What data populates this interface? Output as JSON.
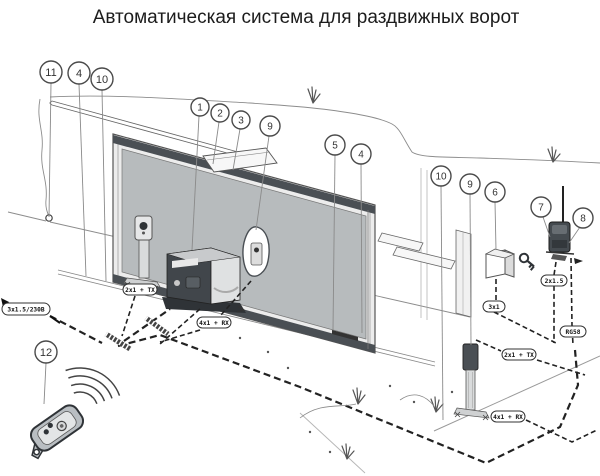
{
  "title": "Автоматическая система для раздвижных ворот",
  "callouts": [
    {
      "n": "11"
    },
    {
      "n": "4"
    },
    {
      "n": "10"
    },
    {
      "n": "1"
    },
    {
      "n": "2"
    },
    {
      "n": "3"
    },
    {
      "n": "9"
    },
    {
      "n": "5"
    },
    {
      "n": "4"
    },
    {
      "n": "10"
    },
    {
      "n": "9"
    },
    {
      "n": "6"
    },
    {
      "n": "7"
    },
    {
      "n": "8"
    },
    {
      "n": "12"
    }
  ],
  "cables": {
    "power": "3x1.5/230В",
    "tx_left": "2x1 + TX",
    "rx_left": "4x1 + RX",
    "flasher": "2x1.5",
    "key": "3x1",
    "coax": "RG58",
    "tx_right": "2x1 + TX",
    "rx_right": "4x1 + RX"
  },
  "colors": {
    "line": "#4a4f54",
    "gate_panel": "#b7bbbd",
    "gate_frame": "#ececec",
    "dark_band": "#4a4f54",
    "background": "#ffffff"
  }
}
